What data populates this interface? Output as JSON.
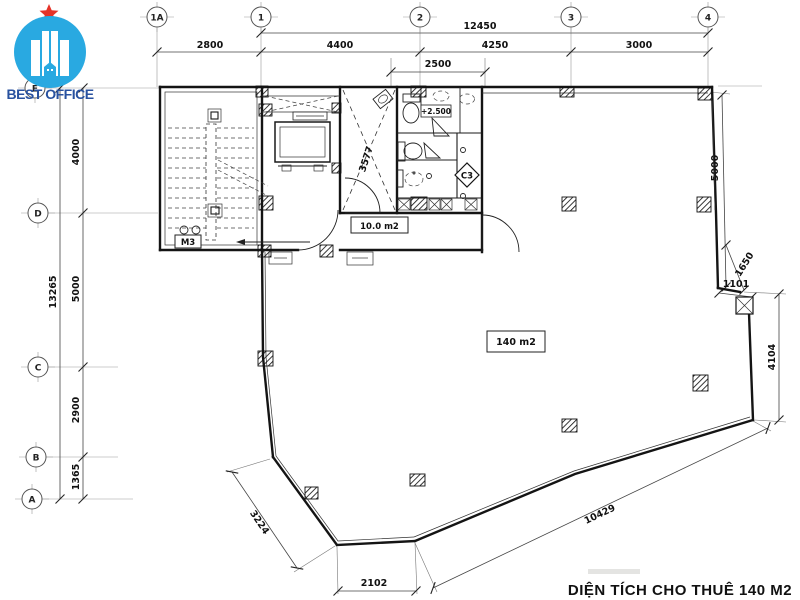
{
  "logo": {
    "brand": "BEST OFFICE"
  },
  "colors": {
    "logo_blue": "#29a9e1",
    "logo_text_blue": "#28519f",
    "star_red": "#e63328",
    "line_dark": "#1a1a1a",
    "dim_text": "#111111"
  },
  "grid": {
    "top": [
      "1A",
      "1",
      "2",
      "3",
      "4"
    ],
    "left": [
      "E",
      "D",
      "C",
      "B",
      "A"
    ]
  },
  "dims": {
    "top": {
      "overall": "12450",
      "bay1": "2800",
      "bay2": "4400",
      "bay3": "4250",
      "bay4": "3000",
      "sub": "2500"
    },
    "left": {
      "overall": "13265",
      "bay1": "4000",
      "bay2": "5000",
      "bay3": "2900",
      "bay4": "1365"
    },
    "right": {
      "upper": "5000",
      "diag": "1650",
      "notch": "1101",
      "lower": "4104"
    },
    "bottom": {
      "slant": "10429",
      "left_diag": "3224",
      "center": "2102"
    },
    "interior": {
      "shaft": "3577"
    }
  },
  "labels": {
    "level": "+2.500",
    "column_mark": "C3",
    "door_mark": "M3",
    "room_small": "10.0 m2",
    "room_main": "140 m2"
  },
  "title": "DIỆN TÍCH CHO THUÊ 140 M2"
}
